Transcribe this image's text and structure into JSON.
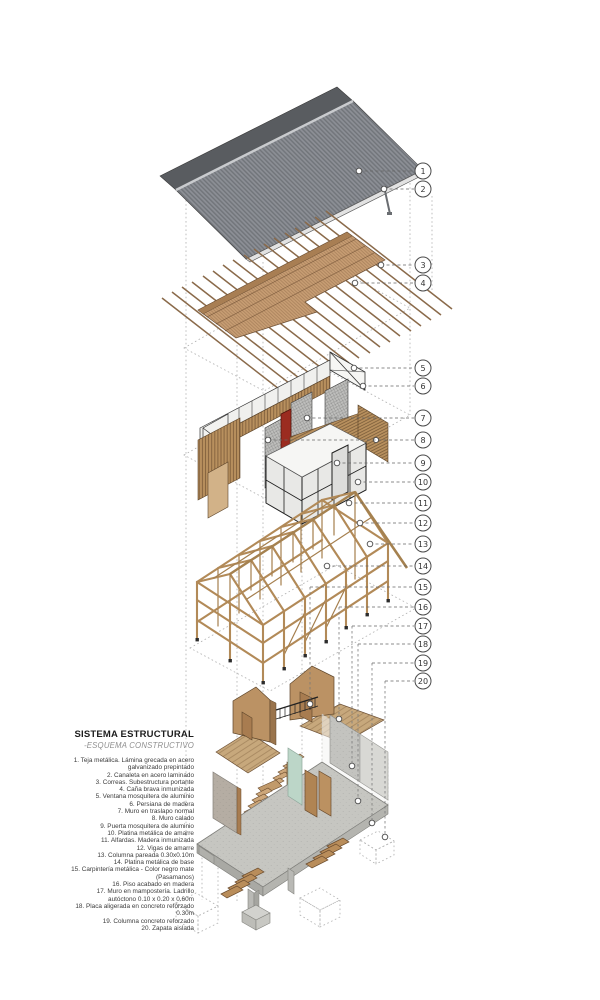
{
  "title": "SISTEMA ESTRUCTURAL",
  "subtitle": "-ESQUEMA CONSTRUCTIVO",
  "legend": {
    "items": [
      "1. Teja metálica. Lámina grecada en acero galvanizado prepintado",
      "2. Canaleta en acero laminado",
      "3. Correas. Subestructura portante",
      "4. Caña brava inmunizada",
      "5. Ventana mosquitera de aluminio",
      "6. Persiana de madera",
      "7. Muro en traslapo normal",
      "8. Muro calado",
      "9. Puerta mosquitera de aluminio",
      "10. Platina metálica de amarre",
      "11. Alfardas. Madera inmunizada",
      "12. Vigas de amarre",
      "13. Columna pareada 0.30x0.10m",
      "14. Platina metálica de base",
      "15. Carpintería metálica - Color negro mate (Pasamanos)",
      "16. Piso acabado en madera",
      "17. Muro en mampostería. Ladrillo autóctono 0.10 x 0.20 x 0.60m",
      "18. Placa aligerada en concreto reforzado 0.30m",
      "19. Columna concreto reforzado",
      "20. Zapata aislada"
    ]
  },
  "callouts": {
    "numbers": [
      "1",
      "2",
      "3",
      "4",
      "5",
      "6",
      "7",
      "8",
      "9",
      "10",
      "11",
      "12",
      "13",
      "14",
      "15",
      "16",
      "17",
      "18",
      "19",
      "20"
    ]
  },
  "colors": {
    "roof_gray": "#84878d",
    "roof_dark": "#595c60",
    "wood_deck": "#c89e74",
    "wood_wall": "#b8905e",
    "wood_frame": "#b28a58",
    "concrete": "#c6c6c1",
    "door_red": "#9b2c20",
    "glass_mint": "#bcd6c8"
  }
}
